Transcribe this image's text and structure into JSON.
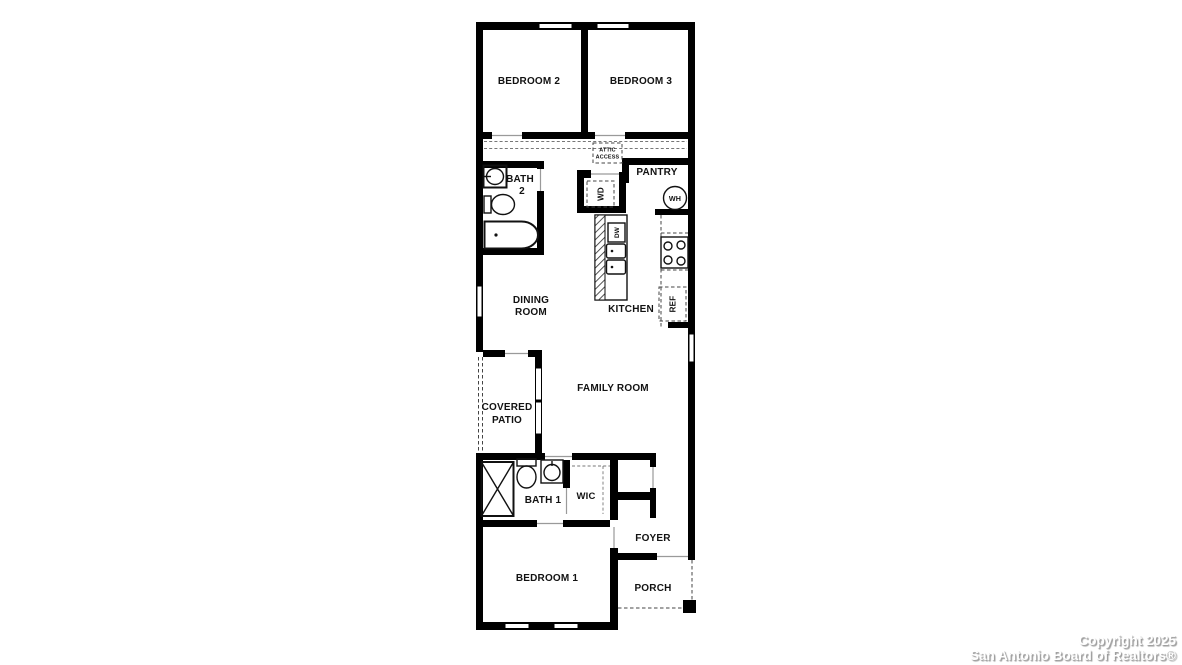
{
  "title": "Residential floor plan",
  "watermark": {
    "line1": "Copyright 2025",
    "line2": "San Antonio Board of Realtors®"
  },
  "colors": {
    "wall": "#000000",
    "background": "#ffffff",
    "label_text": "#121212",
    "dashed_line": "#444444",
    "door_line": "#9a9a9a",
    "watermark_text": "#ffffff",
    "watermark_shadow": "#999999"
  },
  "rooms": {
    "bedroom2": {
      "label": "BEDROOM 2"
    },
    "bedroom3": {
      "label": "BEDROOM 3"
    },
    "bedroom1": {
      "label": "BEDROOM 1"
    },
    "bath2": {
      "line1": "BATH",
      "line2": "2"
    },
    "bath1": {
      "label": "BATH 1"
    },
    "dining": {
      "line1": "DINING",
      "line2": "ROOM"
    },
    "kitchen": {
      "label": "KITCHEN"
    },
    "family": {
      "label": "FAMILY ROOM"
    },
    "patio": {
      "line1": "COVERED",
      "line2": "PATIO"
    },
    "wic": {
      "label": "WIC"
    },
    "foyer": {
      "label": "FOYER"
    },
    "porch": {
      "label": "PORCH"
    },
    "pantry": {
      "label": "PANTRY"
    }
  },
  "fixtures": {
    "attic": {
      "line1": "ATTIC",
      "line2": "ACCESS"
    },
    "wd": {
      "label": "WD"
    },
    "dw": {
      "label": "DW"
    },
    "wh": {
      "label": "WH"
    },
    "ref": {
      "label": "REF"
    }
  }
}
